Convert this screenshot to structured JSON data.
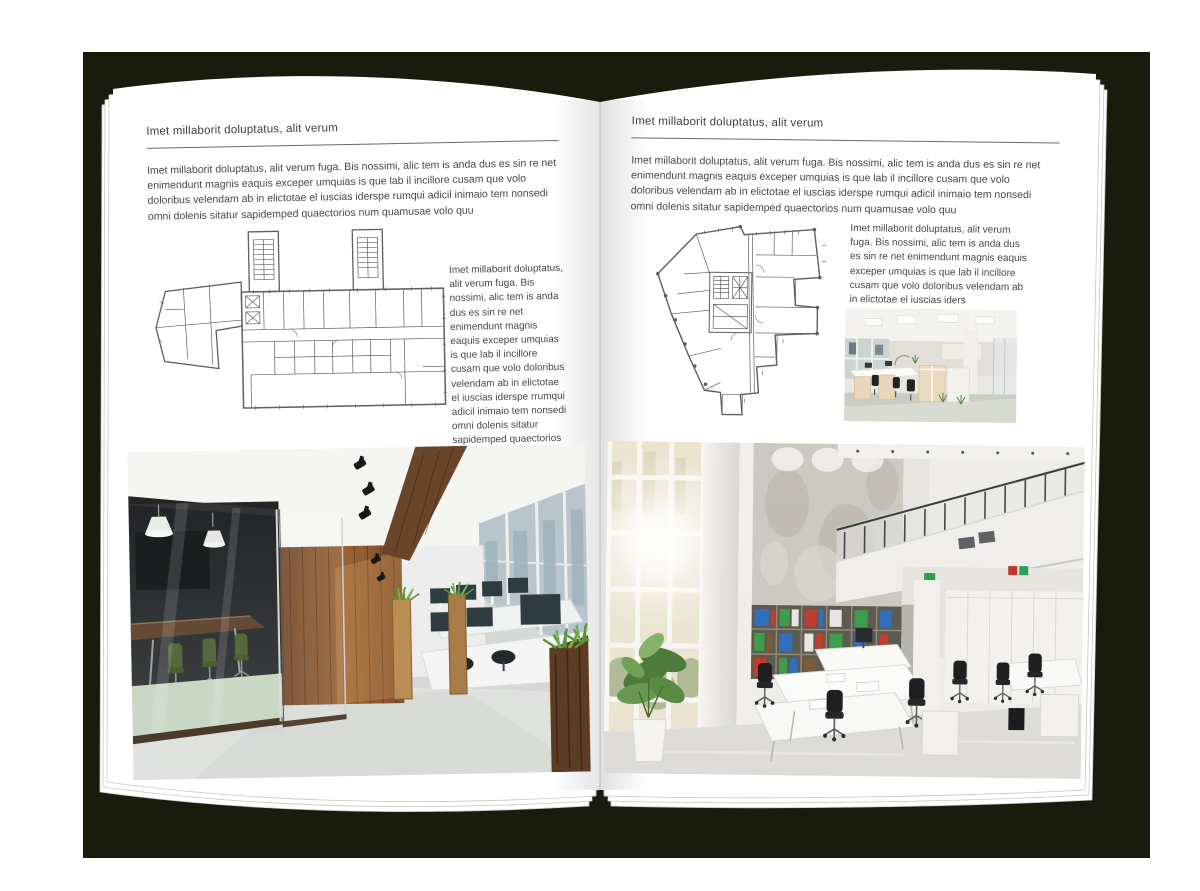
{
  "document_type": "magazine-spread-mockup",
  "colors": {
    "backdrop": "#191b0d",
    "page": "#ffffff",
    "text": "#474747",
    "rule": "#6a6a6a"
  },
  "left_page": {
    "header": "Imet millaborit doluptatus, alit verum",
    "intro": "Imet millaborit doluptatus, alit verum fuga. Bis nossimi, alic tem is anda dus es sin re net enimendunt magnis eaquis exceper umquias is que lab il incillore cusam que volo doloribus velendam ab in elictotae el iuscias iderspe rumqui adicil inimaio tem nonsedi omni dolenis sitatur sapidemped quaectorios num quamusae volo quu",
    "side_text": "Imet millaborit doluptatus, alit verum fuga. Bis nossimi, alic tem is anda dus es sin re net enimendunt magnis eaquis exceper umquias is que lab il incillore cusam que volo doloribus velendam ab in elictotae el iuscias iderspe rrumqui adicil inimaio tem nonsedi omni dolenis sitatur sapidemped quaectorios num quamusae volo quu"
  },
  "right_page": {
    "header": "Imet millaborit doluptatus, alit verum",
    "intro": "Imet millaborit doluptatus, alit verum fuga. Bis nossimi, alic tem is anda dus es sin re net enimendunt magnis eaquis exceper umquias is que lab il incillore cusam que volo doloribus velendam ab in elictotae el iuscias iderspe rumqui adicil inimaio tem nonsedi omni dolenis sitatur sapidemped quaectorios num quamusae volo quu",
    "side_text": "Imet millaborit doluptatus, alit verum fuga. Bis nossimi, alic tem is anda dus es sin re net enimendunt magnis eaquis exceper umquias is que lab il incillore cusam que volo doloribus velendam ab in elictotae el iuscias iders"
  }
}
